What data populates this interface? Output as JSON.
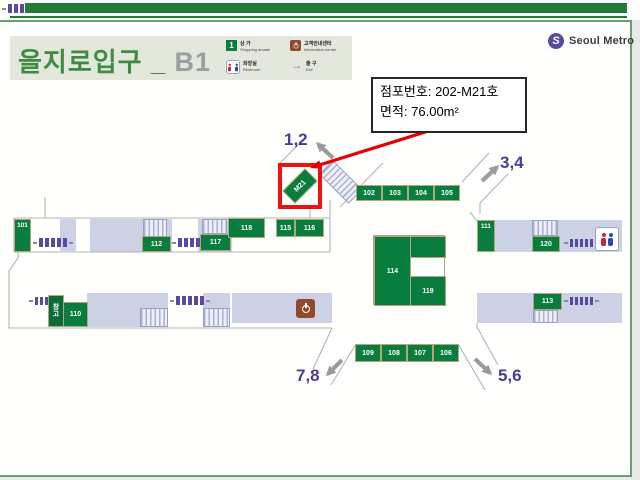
{
  "chrome": {
    "brand": "Seoul Metro",
    "monogram": "S"
  },
  "header": {
    "station": "을지로입구",
    "separator": "_",
    "level": "B1",
    "legend": [
      {
        "icon": "shop-number-icon",
        "icon_label": "1",
        "kr": "상 가",
        "en": "Shopping arcade"
      },
      {
        "icon": "info-icon",
        "kr": "고객안내센터",
        "en": "Information center"
      },
      {
        "icon": "restroom-icon",
        "kr": "화장실",
        "en": "Restroom"
      },
      {
        "icon": "exit-arrow-icon",
        "icon_label": "→",
        "kr": "출 구",
        "en": "Exit"
      }
    ]
  },
  "callout": {
    "store_no_line": "점포번호: 202-M21호",
    "area_line": "면적: 76.00m²"
  },
  "plan": {
    "highlight": "M21",
    "warehouse": "창고",
    "exits": {
      "e12": "1,2",
      "e34": "3,4",
      "e56": "5,6",
      "e78": "7,8"
    },
    "stores": {
      "s101": "101",
      "s102": "102",
      "s103": "103",
      "s104": "104",
      "s105": "105",
      "s106": "106",
      "s107": "107",
      "s108": "108",
      "s109": "109",
      "s110": "110",
      "s111": "111",
      "s112": "112",
      "s113": "113",
      "s114": "114",
      "s115": "115",
      "s116": "116",
      "s117": "117",
      "s118": "118",
      "s119": "119",
      "s120": "120"
    }
  },
  "colors": {
    "store_green": "#087d3e",
    "store_border": "#b3a678",
    "corridor_lavender": "#ccd1e6",
    "gate_purple": "#5a49a0",
    "exit_label_purple": "#4a3b97",
    "highlight_red": "#ee1111",
    "topbar_green": "#1f7b35"
  }
}
